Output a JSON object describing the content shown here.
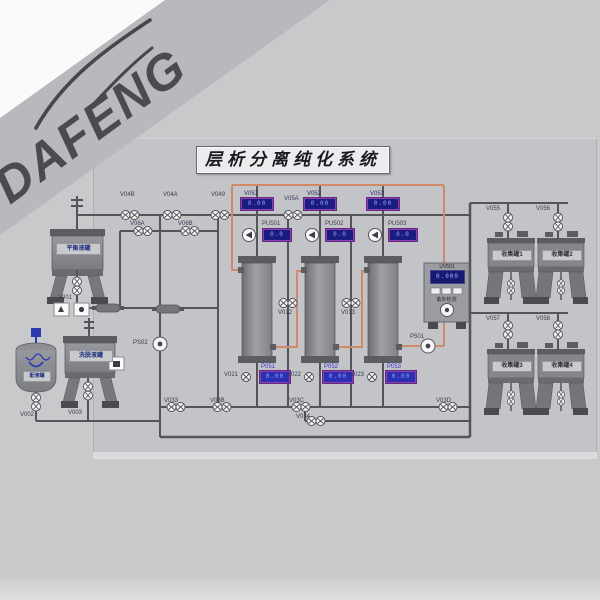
{
  "watermark": {
    "text": "DAFENG"
  },
  "title": "层析分离纯化系统",
  "tanks": {
    "buffer": "平衡液罐",
    "mix": "配液罐",
    "eluent": "洗脱液罐",
    "collect1": "收集罐1",
    "collect2": "收集罐2",
    "collect3": "收集罐3",
    "collect4": "收集罐4"
  },
  "detector": {
    "tag": "UV501",
    "value": "0.000",
    "label": "紫外检测"
  },
  "top_displays": [
    {
      "tag": "V051",
      "value": "0.00"
    },
    {
      "tag": "V052",
      "value": "0.00"
    },
    {
      "tag": "V053",
      "value": "0.00"
    }
  ],
  "pumps": [
    {
      "tag": "PU501",
      "value": "0.0"
    },
    {
      "tag": "PU502",
      "value": "0.0"
    },
    {
      "tag": "PU503",
      "value": "0.0"
    }
  ],
  "bottom_displays": [
    {
      "tag": "P051",
      "value": "0.00"
    },
    {
      "tag": "P052",
      "value": "0.00"
    },
    {
      "tag": "P053",
      "value": "0.00"
    }
  ],
  "valves": {
    "v001": "V001",
    "v002": "V002",
    "v003": "V003",
    "v04b": "V04B",
    "v04a": "V04A",
    "v049": "V049",
    "v05a": "V05A",
    "v06a": "V06A",
    "v06b": "V06B",
    "v012": "V012",
    "v013": "V013",
    "v021": "V021",
    "v022": "V022",
    "v023": "V023",
    "v033": "V033",
    "v03b": "V03B",
    "v03c": "V03C",
    "v03d": "V03D",
    "v034": "V034",
    "v055": "V055",
    "v056": "V056",
    "v057": "V057",
    "v058": "V058",
    "p501": "P501",
    "ps02": "PS02"
  }
}
